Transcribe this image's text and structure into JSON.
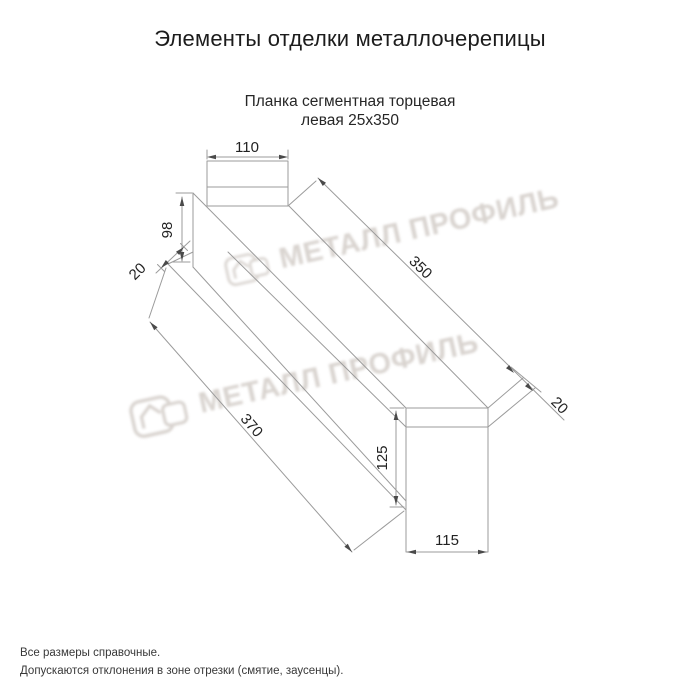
{
  "page": {
    "title": "Элементы отделки металлочерепицы"
  },
  "product": {
    "subtitle_line1": "Планка сегментная торцевая",
    "subtitle_line2": "левая 25х350"
  },
  "dimensions": {
    "top_flange_width": "110",
    "left_end_height": "98",
    "left_lip": "20",
    "top_edge_length": "350",
    "right_lip": "20",
    "bottom_edge_length": "370",
    "end_face_height": "125",
    "end_face_width": "115"
  },
  "watermark": {
    "text": "МЕТАЛЛ ПРОФИЛЬ",
    "logo": "metall-profil-logo"
  },
  "footnotes": {
    "line1": "Все размеры справочные.",
    "line2": "Допускаются отклонения в зоне отрезки (смятие, заусенцы)."
  },
  "colors": {
    "background": "#ffffff",
    "line": "#9b9b9b",
    "dim_text": "#222222",
    "title_text": "#1c1c1c",
    "watermark": "#d2ccc7"
  }
}
